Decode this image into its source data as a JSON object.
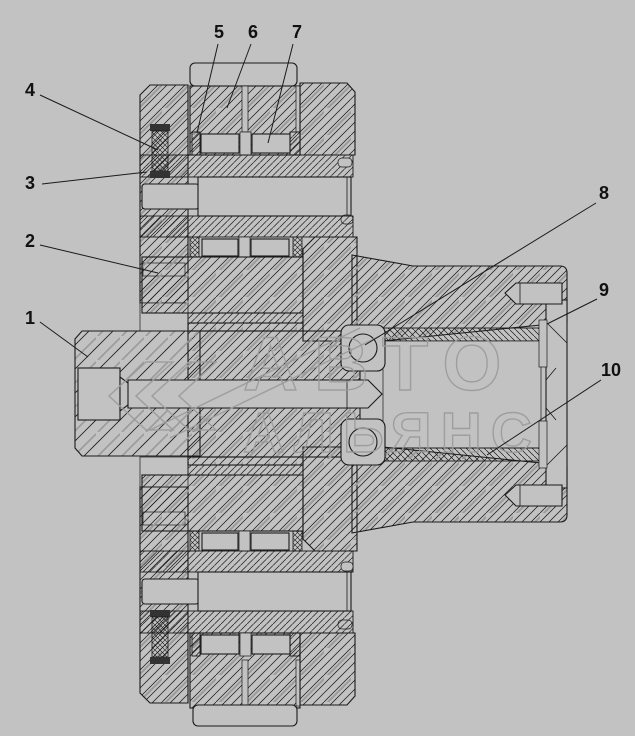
{
  "colors": {
    "background": "#c2c2c2",
    "line": "#1a1a1a",
    "hatch_accent": "#9a9a9a",
    "watermark": "#9b9b9b"
  },
  "watermark": {
    "line1": "АВТО",
    "line2": "АЛЬЯНС"
  },
  "callouts": {
    "labels": [
      "1",
      "2",
      "3",
      "4",
      "5",
      "6",
      "7",
      "8",
      "9",
      "10"
    ]
  }
}
